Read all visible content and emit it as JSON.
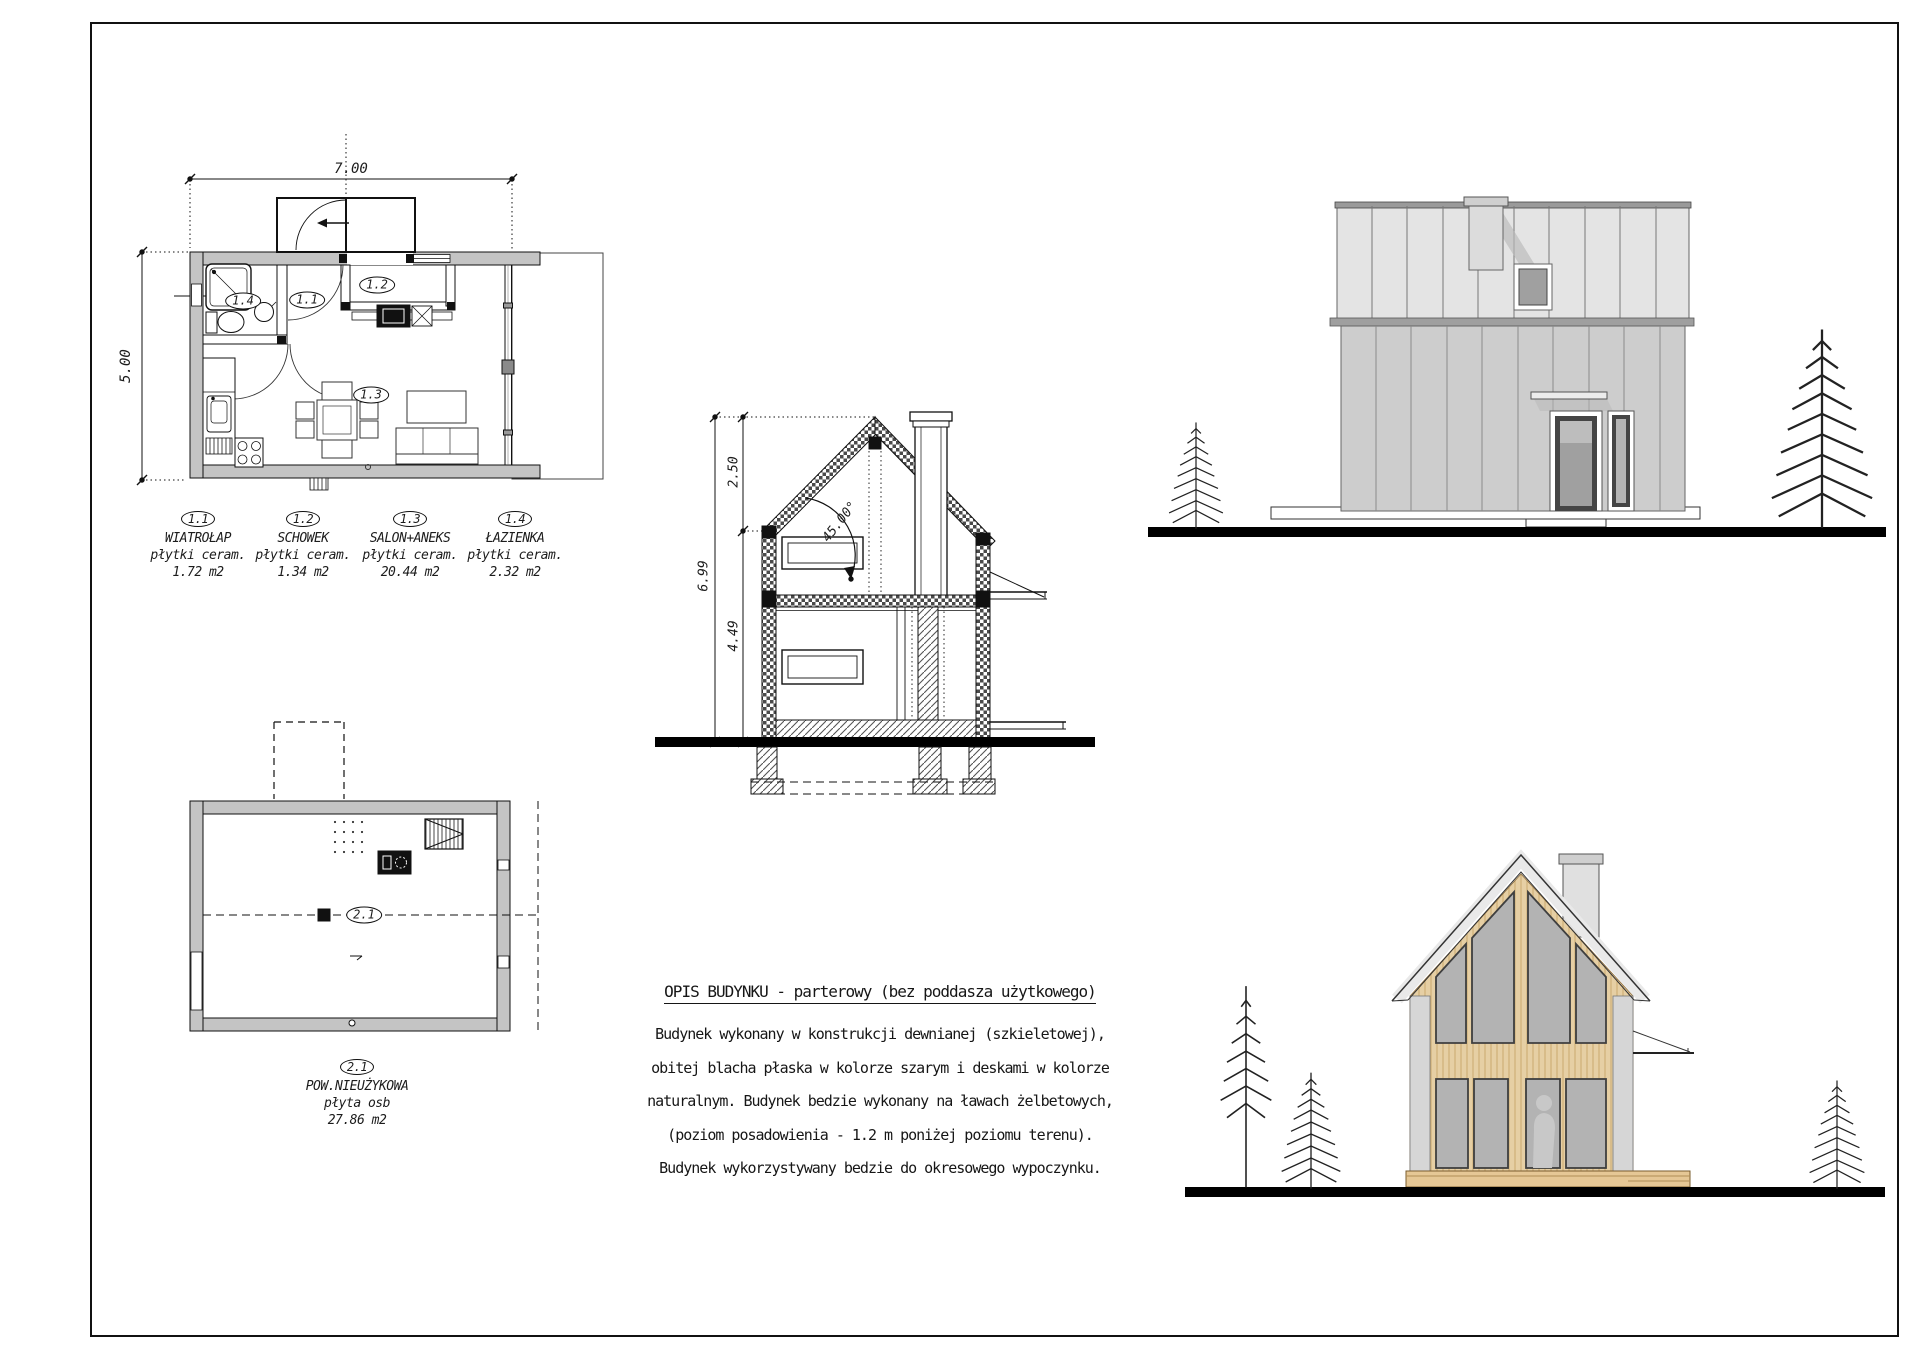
{
  "plan_ground": {
    "dim_width": "7.00",
    "dim_height": "5.00",
    "rooms": [
      {
        "id": "1.1",
        "name": "WIATROŁAP",
        "finish": "płytki ceram.",
        "area": "1.72 m2"
      },
      {
        "id": "1.2",
        "name": "SCHOWEK",
        "finish": "płytki ceram.",
        "area": "1.34 m2"
      },
      {
        "id": "1.3",
        "name": "SALON+ANEKS",
        "finish": "płytki ceram.",
        "area": "20.44 m2"
      },
      {
        "id": "1.4",
        "name": "ŁAZIENKA",
        "finish": "płytki ceram.",
        "area": "2.32 m2"
      }
    ]
  },
  "plan_attic": {
    "room": {
      "id": "2.1",
      "name": "POW.NIEUŻYKOWA",
      "finish": "płyta osb",
      "area": "27.86 m2"
    }
  },
  "section": {
    "dim_ridge": "2.50",
    "dim_total": "6.99",
    "dim_wall": "4.49",
    "roof_angle": "45.00°"
  },
  "description": {
    "title": "OPIS BUDYNKU - parterowy (bez poddasza użytkowego)",
    "lines": [
      "Budynek wykonany w konstrukcji dewnianej (szkieletowej),",
      "obitej blacha płaska w kolorze szarym i deskami w kolorze",
      "naturalnym. Budynek bedzie wykonany na ławach żelbetowych,",
      "(poziom posadowienia - 1.2 m poniżej poziomu terenu).",
      "Budynek wykorzystywany bedzie do okresowego wypoczynku."
    ]
  },
  "colors": {
    "wall_fill": "#c4c4c4",
    "elev_roof": "#e4e4e4",
    "elev_wall": "#cdcdcd",
    "chimney": "#dcdcdc",
    "glass": "#a0a0a0",
    "glass_front": "#b3b3b3",
    "wood": "#e6cfa4",
    "deck": "#e5c795",
    "shadow": "#b8b8b8",
    "silhouette": "#c8c8c8",
    "ground": "#000000"
  }
}
